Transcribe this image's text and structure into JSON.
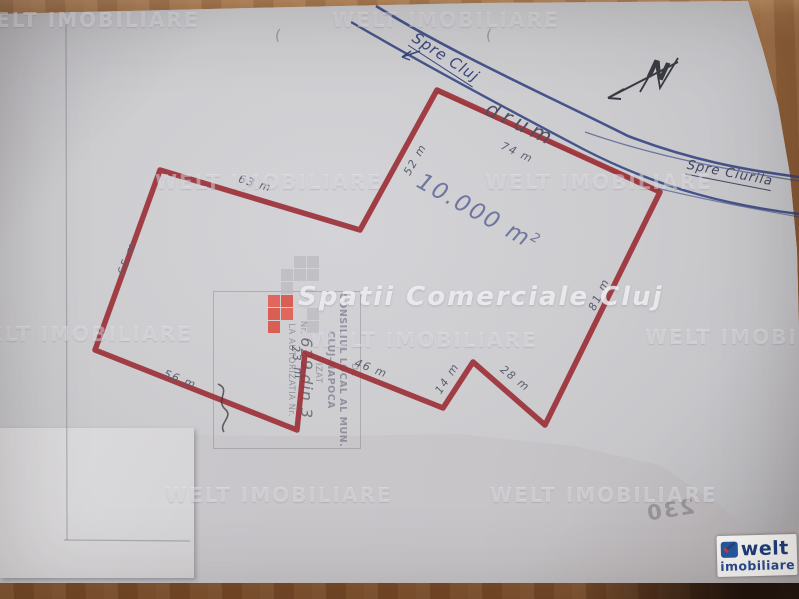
{
  "watermark": {
    "tile_text": "WELT IMOBILIARE",
    "brand_text": "Spatii Comerciale Cluj",
    "logo_grid": [
      "..gg",
      ".ggg",
      ".g..",
      "Rr..",
      "rR.g",
      "r..g"
    ],
    "colors": {
      "gray": "#bcbcc0",
      "red": "#d94f43",
      "red_bright": "#e2574a"
    }
  },
  "map": {
    "area_label": "10.000 m",
    "area_sup": "2",
    "road_label": "drum",
    "direction_left_arrow": "←",
    "direction_left": "Spre Cluj",
    "direction_right": "Spre Ciurila",
    "north_label": "N",
    "measurements": [
      {
        "label": "63 m"
      },
      {
        "label": "52 m"
      },
      {
        "label": "74 m"
      },
      {
        "label": "81 m"
      },
      {
        "label": "28 m"
      },
      {
        "label": "14 m"
      },
      {
        "label": "46 m"
      },
      {
        "label": "23 m"
      },
      {
        "label": "56 m"
      },
      {
        "label": "65 m"
      }
    ],
    "ink_colors": {
      "parcel_red": "#9c3138",
      "road_blue": "#2e3e7e",
      "pencil": "#5a5e6e"
    }
  },
  "stamp": {
    "lines": [
      "DE",
      "CONSILIUL LOCAL AL MUN.",
      "CLUJ-NAPOCA",
      "VIZAT",
      "LA AUTORIZATIA Nr."
    ],
    "nr_prefix": "Nr.",
    "number": "629",
    "date_part": "din 3"
  },
  "marks": {
    "paren_glyph": "(",
    "bleed_text": "230"
  },
  "logo": {
    "word": "welt",
    "sub": "imobiliare"
  }
}
